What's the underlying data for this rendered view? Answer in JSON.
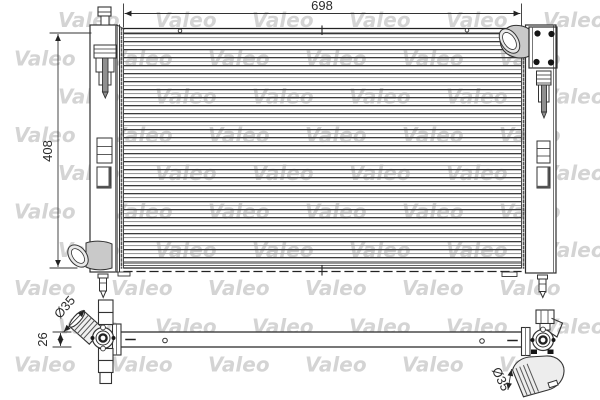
{
  "watermark": {
    "text": "Valeo"
  },
  "dimensions": {
    "core_width": "698",
    "overall_height": "408",
    "tube_thickness": "26",
    "left_pipe_diameter": "Ø35",
    "right_pipe_diameter": "Ø35"
  }
}
